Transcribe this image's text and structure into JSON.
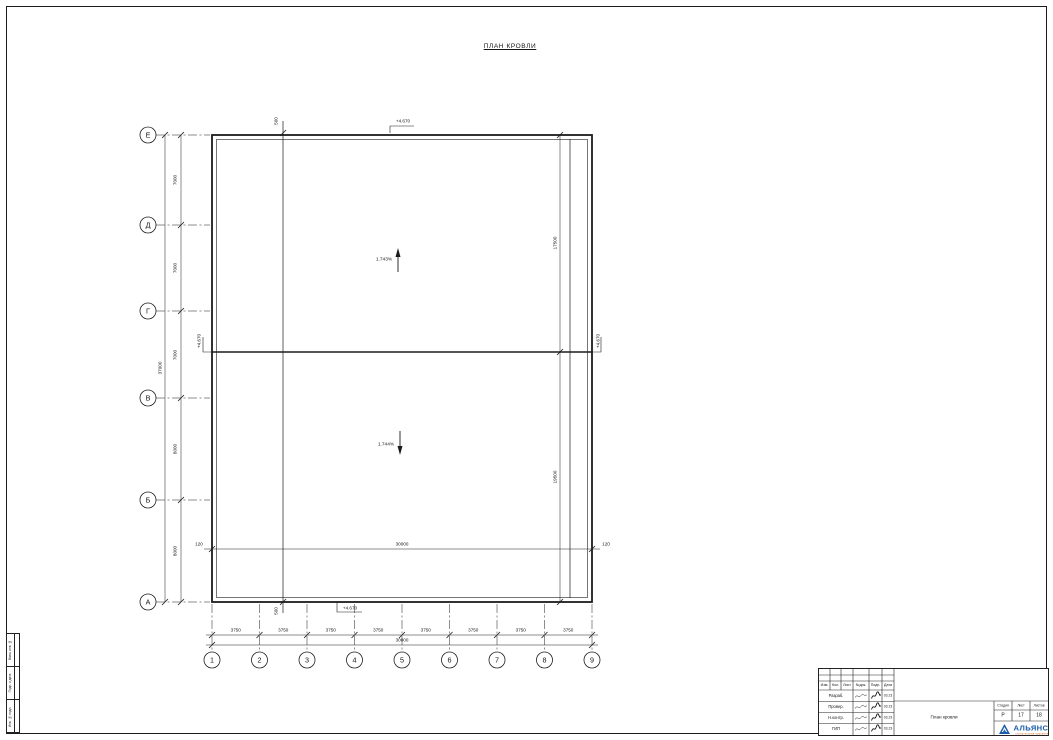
{
  "sheet": {
    "title": "ПЛАН КРОВЛИ"
  },
  "colors": {
    "line": "#1c1c1c",
    "logo_blue": "#1a5dab",
    "logo_orange": "#d2691e"
  },
  "plan": {
    "row_axes": [
      "Е",
      "Д",
      "Г",
      "В",
      "Б",
      "А"
    ],
    "col_axes": [
      "1",
      "2",
      "3",
      "4",
      "5",
      "6",
      "7",
      "8",
      "9"
    ],
    "row_dims": [
      "7000",
      "7000",
      "7000",
      "8000",
      "8000"
    ],
    "row_total": "37000",
    "col_dims": [
      "3750",
      "3750",
      "3750",
      "3750",
      "3750",
      "3750",
      "3750",
      "3750"
    ],
    "col_total": "30000",
    "inner_bottom_dim": "30000",
    "right_dims": [
      "17500",
      "19500"
    ],
    "edge_dims": {
      "top_offset": "500",
      "bottom_offset": "500",
      "left_overhang": "120",
      "right_overhang": "120"
    },
    "slopes": [
      {
        "value": "1.743%",
        "direction": "up"
      },
      {
        "value": "1.744%",
        "direction": "down"
      }
    ],
    "elevation_marks": [
      "+4.670",
      "+4.670",
      "+4.670",
      "+4.670"
    ]
  },
  "side_stamp": [
    "Взам. инв. №",
    "Подп. и дата",
    "Инв. № подл."
  ],
  "title_block": {
    "header_cols": [
      "Изм.",
      "Кол.",
      "Лист",
      "№док.",
      "Подп.",
      "Дата"
    ],
    "rows": [
      {
        "role": "Разраб.",
        "date": "03.23"
      },
      {
        "role": "Провер.",
        "date": "03.23"
      },
      {
        "role": "Н.контр.",
        "date": "03.23"
      },
      {
        "role": "ГИП",
        "date": "03.23"
      }
    ],
    "doc_name": "План кровли",
    "stage_header": [
      "Стадия",
      "Лист",
      "Листов"
    ],
    "stage": "Р",
    "sheet_no": "17",
    "sheets_total": "18",
    "logo_name": "АЛЬЯНС",
    "logo_subtitle": "строительная компания"
  }
}
